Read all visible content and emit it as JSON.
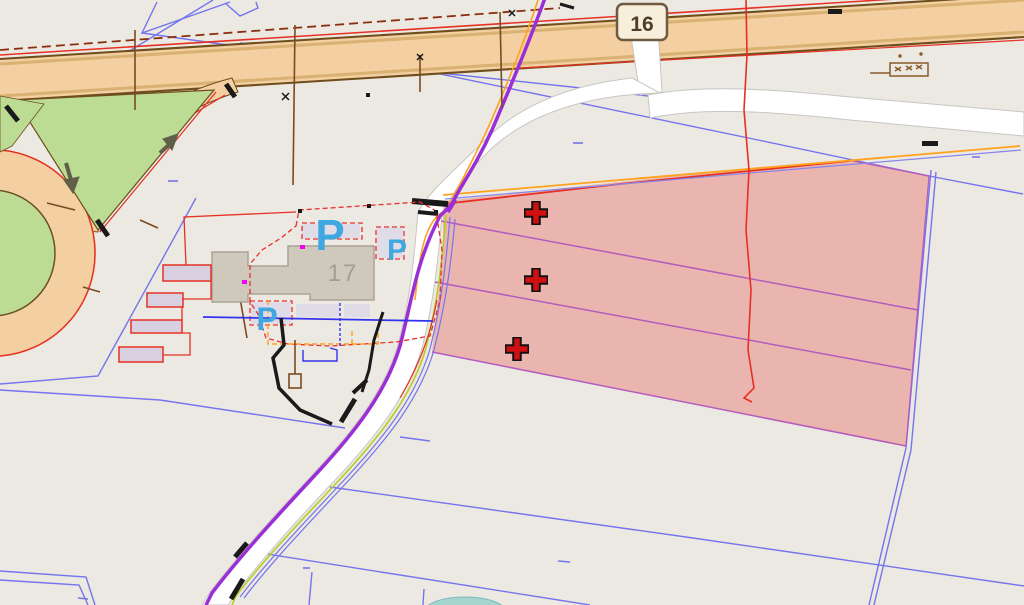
{
  "canvas": {
    "width": 1024,
    "height": 605,
    "kind": "gis-map-viewport"
  },
  "labels": {
    "route_badge": "16",
    "building_number": "17",
    "parking_1": "P",
    "parking_2": "P",
    "parking_3": "P"
  },
  "markers": {
    "cross_count": 3,
    "cross_positions": [
      [
        536,
        213
      ],
      [
        536,
        280
      ],
      [
        517,
        349
      ]
    ],
    "cross_meaning": "selected-parcel-centroid-marker"
  },
  "highlighted_parcels": {
    "count": 3,
    "fill": "#E96E69",
    "divider_color": "#B45BBE",
    "top_edge_color": "#E53022"
  },
  "colors": {
    "background": "#ECE9E2",
    "road_fill": "#F3CFA1",
    "road_edge_brown": "#6E4E1E",
    "road_edge_red": "#E53022",
    "green_area": "#BCDB93",
    "parcel_line_blue": "#7474EE",
    "utility_purple": "#9B2FD6",
    "utility_orange": "#FFA21E",
    "utility_chartreuse": "#B9CC22",
    "utility_black": "#1A1A1A",
    "utility_brown": "#7B4A22",
    "building_fill": "#CFC8BD",
    "building_number_color": "#A59C8F",
    "parking_label_blue": "#3FA8E0",
    "badge_fill": "#F7EEDC",
    "badge_border": "#6E5A40",
    "badge_text": "#4E3D28",
    "shed_fill": "#D8D0E0",
    "pond_teal": "#A6D5CE",
    "white_road": "#FFFFFF"
  },
  "icons": {
    "cross_marker": "plus-cross-icon",
    "arrow_down": "direction-arrow-icon",
    "arrow_up": "direction-arrow-icon",
    "culvert": "culvert-symbol-icon"
  }
}
